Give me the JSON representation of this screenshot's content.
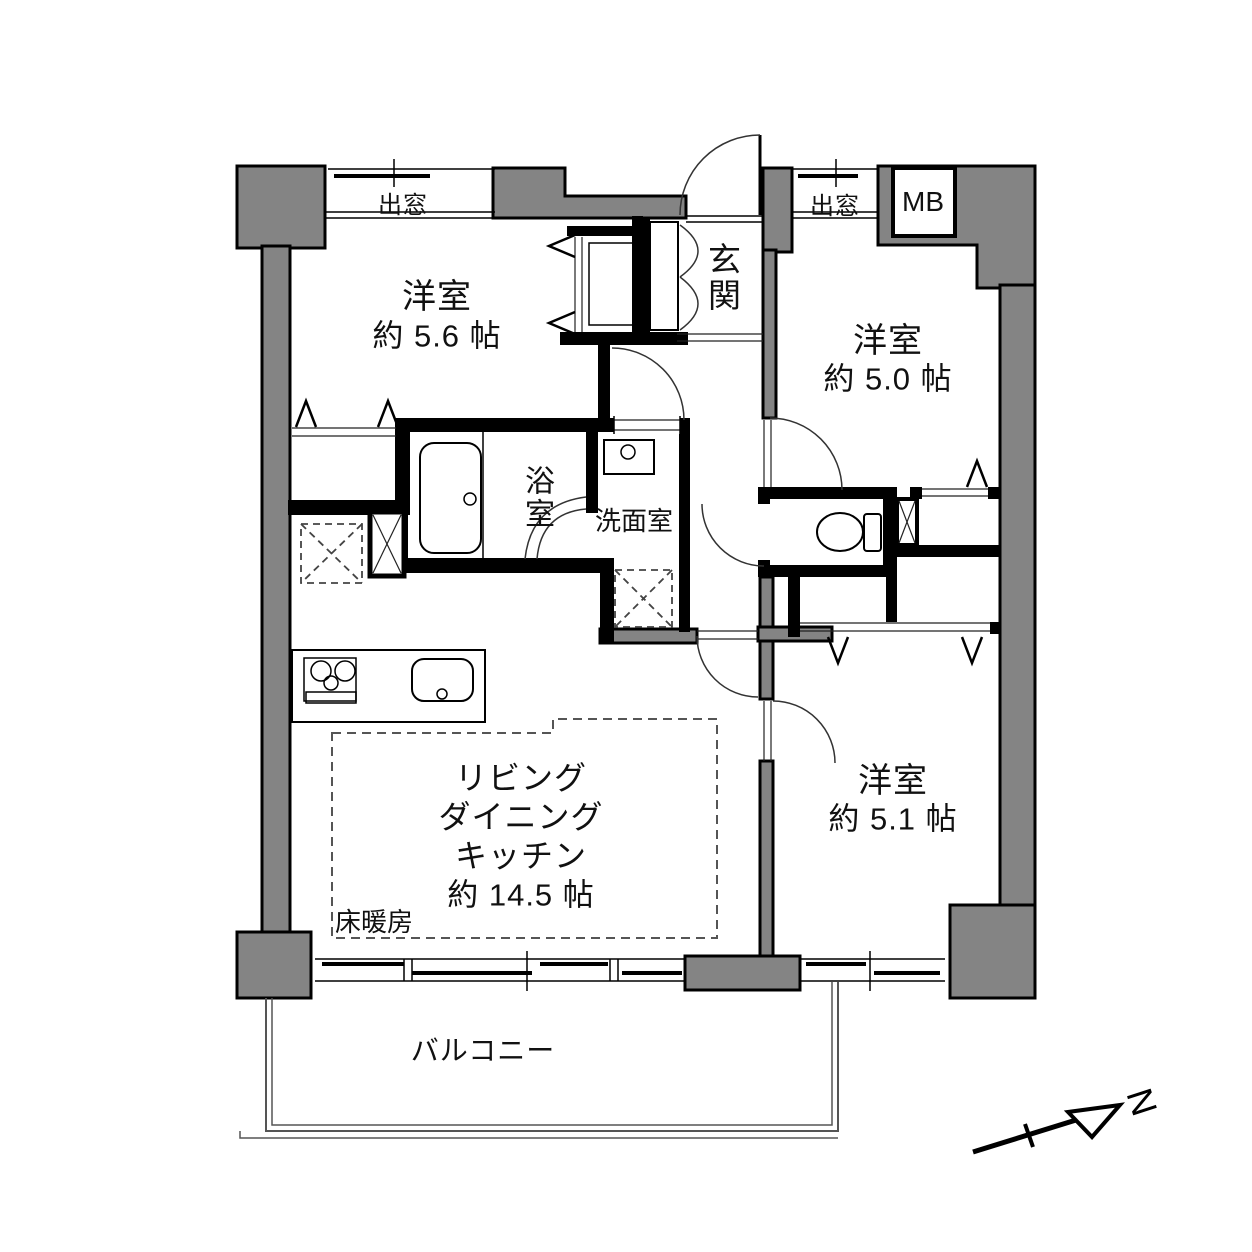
{
  "rooms": {
    "western_room_1": {
      "name": "洋室",
      "size": "約 5.6 帖"
    },
    "western_room_2": {
      "name": "洋室",
      "size": "約 5.0 帖"
    },
    "western_room_3": {
      "name": "洋室",
      "size": "約 5.1 帖"
    },
    "ldk": {
      "name_lines": [
        "リビング",
        "ダイニング",
        "キッチン"
      ],
      "size": "約 14.5 帖",
      "floor_heating": "床暖房"
    },
    "entrance": {
      "name": "玄関"
    },
    "bathroom": {
      "name": "浴室"
    },
    "washroom": {
      "name": "洗面室"
    },
    "balcony": {
      "name": "バルコニー"
    }
  },
  "features": {
    "bay_window_left": "出窓",
    "bay_window_right": "出窓",
    "meter_box": "MB"
  },
  "compass": {
    "north": "N"
  },
  "colors": {
    "wall_fill": "#848484",
    "line": "#000000",
    "background": "#ffffff"
  }
}
